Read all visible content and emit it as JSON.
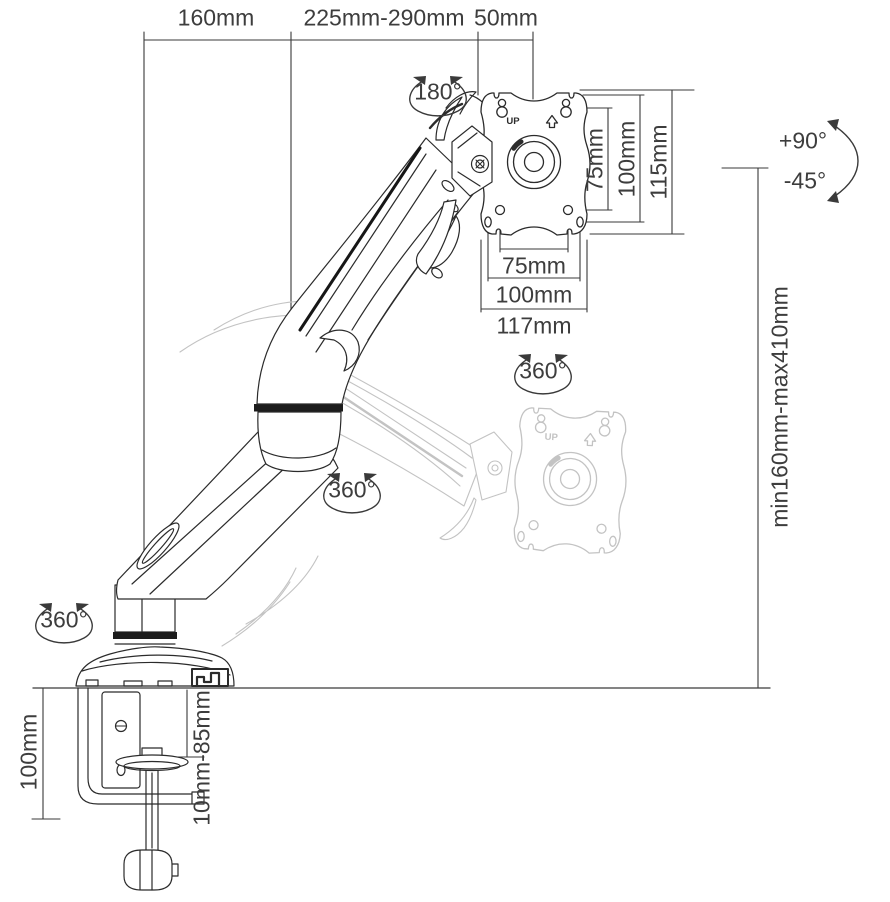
{
  "colors": {
    "ink": "#2b2b2b",
    "dim_line": "#3a3a3a",
    "label_text": "#3d3d3d",
    "ghost": "#c3c3c3"
  },
  "dimensions": {
    "top_width_base_to_elbow": "160mm",
    "top_width_arm_extension": "225mm-290mm",
    "top_width_head": "50mm",
    "vesa_vertical_hole_spacing": "75mm",
    "vesa_vertical_hole_spacing_max": "100mm",
    "vesa_plate_height": "115mm",
    "vesa_horizontal_hole_spacing": "75mm",
    "vesa_horizontal_hole_spacing_max": "100mm",
    "vesa_plate_width": "117mm",
    "height_adjustment_range": "min160mm-max410mm",
    "clamp_bracket_height": "100mm",
    "desk_thickness_range": "10mm-85mm"
  },
  "rotations": {
    "vesa_plate_rotation": "180°",
    "head_swivel": "360°",
    "arm_swivel": "360°",
    "base_swivel": "360°",
    "tilt_up": "+90°",
    "tilt_down": "-45°"
  },
  "vesa_plate": {
    "orientation_label": "UP"
  }
}
